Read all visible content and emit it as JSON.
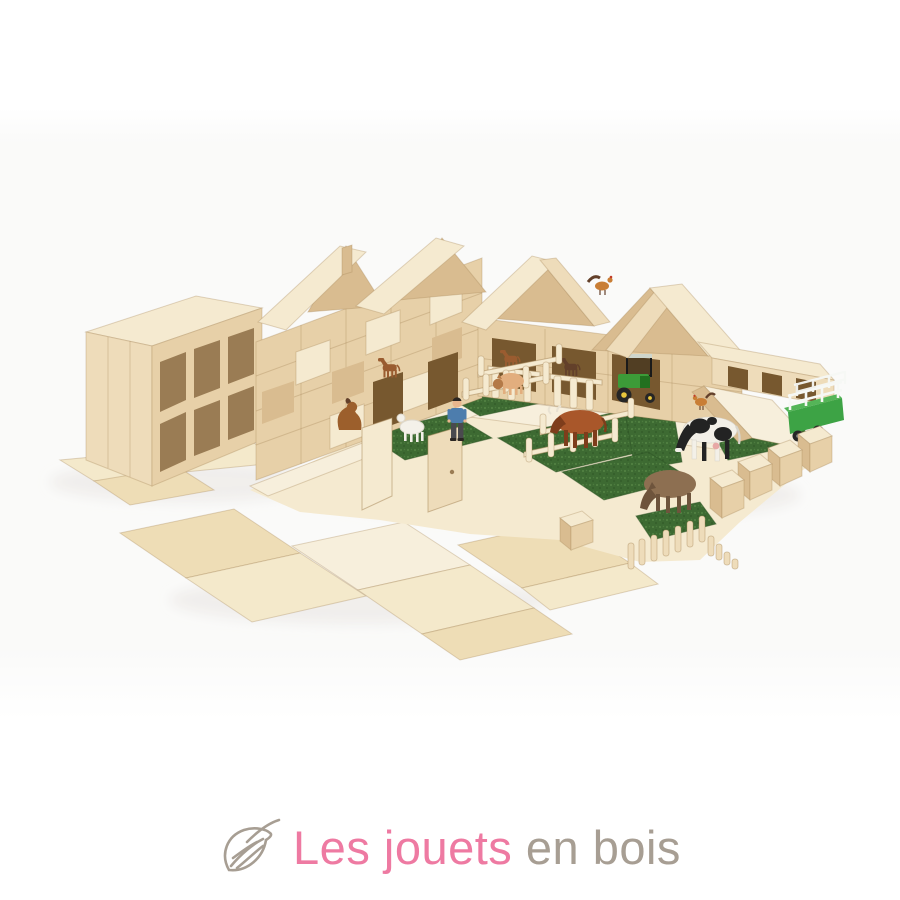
{
  "brand": {
    "logo": {
      "icon": "leaf",
      "text_primary": "Les jouets",
      "text_secondary": " en bois"
    }
  },
  "palette": {
    "page_bg": "#ffffff",
    "backdrop_tint": "#fafaf9",
    "logo_pink": "#ee7aa2",
    "logo_grey": "#a79e93",
    "wood_pale": "#f5ead0",
    "wood_light": "#eedcba",
    "wood": "#e7d0a8",
    "wood_mid": "#d9bc90",
    "wood_dark": "#c3a174",
    "opening": "#9a7c54",
    "opening_dark": "#77582f",
    "seam": "#a98a5c",
    "plywood_a": "#f4e9cb",
    "plywood_b": "#eeddb6",
    "plywood_c": "#f7efdc",
    "grass": "#3d6a32",
    "grass_light": "#5c8c49",
    "grass_dark": "#2c5124",
    "tractor_green": "#3c9b38",
    "tractor_dark": "#22701f",
    "trailer_green": "#3da345",
    "trailer_green_light": "#54b558",
    "rail_white": "#f6f8f5",
    "wheel_dark": "#262626",
    "hub_yellow": "#e8c63c",
    "cow_white": "#f3f0e8",
    "cow_black": "#232323",
    "bull_brown": "#a9572a",
    "bull_dark": "#7e3d1b",
    "pig_tan": "#e2ae7e",
    "pig_head": "#b47a48",
    "sheep_brown": "#8d6f51",
    "sheep_dark": "#6e543c",
    "sheep_white": "#f4f1e9",
    "dog_brown": "#9c5f2c",
    "horse_chestnut": "#9a5c30",
    "horse_dark": "#63402a",
    "chicken_orange": "#c97e35",
    "comb_red": "#c23b28",
    "skin": "#e9b68d",
    "shirt_blue": "#4d7dad",
    "pants_grey": "#4a4a4e",
    "hair_dark": "#2b2622",
    "shadow": "#e7e4df"
  }
}
